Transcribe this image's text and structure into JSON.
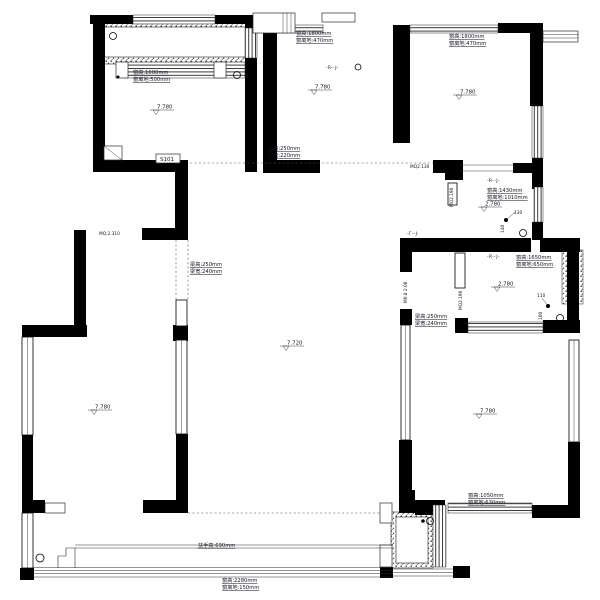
{
  "drawing": {
    "type": "architectural-floor-plan",
    "units": "mm",
    "wall_color": "#000000",
    "background": "#ffffff"
  },
  "labels": {
    "tl_win1": "窗高:1000mm",
    "tl_win2": "窗离地:500mm",
    "tl_slide": "-R--J-",
    "tl_door_tag": "S101",
    "mid_win1": "窗高:1800mm",
    "mid_win2": "窗离地:470mm",
    "tr_win1": "窗高:1800mm",
    "tr_win2": "窗离地:470mm",
    "beam_c1": "梁高:250mm",
    "beam_c2": "梁宽:220mm",
    "mq_2130": "MQ2.130",
    "mq_2310": "MQ:2.310",
    "beam_h1": "梁高:250mm",
    "beam_h2": "梁宽:240mm",
    "k_slide": "-R--J-",
    "k_win1": "窗高:1430mm",
    "k_win2": "窗离地:1010mm",
    "k_dim430": "430",
    "k_dim140": "140",
    "mq_2190_a": "MQ2.190",
    "slide2": "-Γ--J-",
    "door_tag_v": "M0.8 2.08",
    "mq_2190_b": "MQ2.190",
    "b_slide": "-R--J-",
    "b_win1": "窗高:1650mm",
    "b_win2": "窗离地:650mm",
    "b_dim110": "110",
    "b_dim100": "100",
    "br_beam1": "梁高:250mm",
    "br_beam2": "梁宽:240mm",
    "br_win1": "窗高:1050mm",
    "br_win2": "窗离地:630mm",
    "rail": "扶手高:690mm",
    "bal_win1": "窗高:2280mm",
    "bal_win2": "窗离地:150mm",
    "elev_tl": "7.780",
    "elev_mid": "7.780",
    "elev_tr": "7.780",
    "elev_k": "2.780",
    "elev_b": "2.780",
    "elev_living": "7.720",
    "elev_bl": "7.780",
    "elev_br": "7.780"
  }
}
